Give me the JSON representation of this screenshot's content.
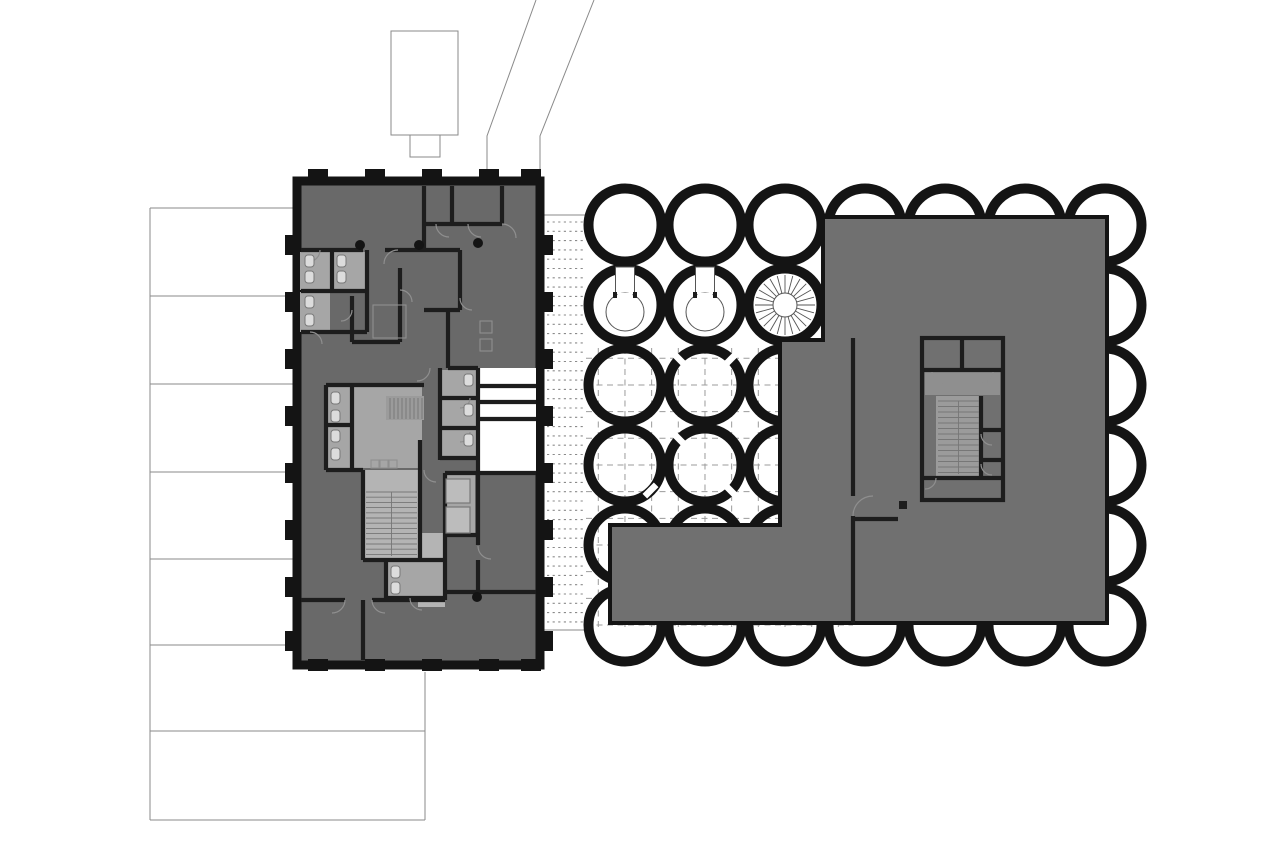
{
  "meta": {
    "title": "architectural-site-plan",
    "description": "Black and white site plan: existing rectangular building at left, courtyard grid of circular pavilions, large new building volume at right with scalloped circle edges",
    "canvas": {
      "width": 1280,
      "height": 854
    }
  },
  "palette": {
    "paper": "#ffffff",
    "ink": "#141414",
    "wall": "#1d1d1d",
    "bldgLeft": "#696969",
    "bldgRight": "#707070",
    "roomLight": "#a6a6a6",
    "stairLight": "#b4b4b4",
    "lobby": "#8f8f8f",
    "coreStair": "#9b9b9b",
    "lineGray": "#8a8a8a",
    "dashGray": "#9b9b9b",
    "arcGray": "#8f8f8f",
    "treadGray": "#777777",
    "spokeGray": "#555555",
    "fixtureFill": "#dcdcdc",
    "fixtureStroke": "#787878",
    "elevBox": "#bcbcbc"
  },
  "site": {
    "access_road": {
      "polylines": [
        [
          536,
          0,
          487,
          136,
          487,
          181
        ],
        [
          594,
          0,
          540,
          136,
          540,
          181
        ]
      ]
    },
    "outbuilding": {
      "rects": [
        [
          391,
          31,
          67,
          104
        ],
        [
          410,
          135,
          30,
          22
        ]
      ]
    },
    "parcel_rows": {
      "h_lines": [
        [
          150,
          208,
          297
        ],
        [
          150,
          296,
          297
        ],
        [
          150,
          384,
          297
        ],
        [
          150,
          472,
          297
        ],
        [
          150,
          559,
          297
        ],
        [
          150,
          645,
          297
        ],
        [
          150,
          731,
          425
        ],
        [
          150,
          820,
          425
        ]
      ],
      "v_lines": [
        [
          150,
          208,
          820
        ],
        [
          425,
          672,
          820
        ]
      ]
    },
    "walkway": {
      "x1": 547,
      "x2": 586,
      "y_start": 222,
      "step": 9.3,
      "count": 44,
      "top_line": [
        544,
        215,
        594,
        215
      ],
      "bottom_line": [
        544,
        630,
        612,
        630
      ]
    }
  },
  "courtyard": {
    "circle_grid": {
      "cols": 7,
      "rows": 6,
      "cx0": 625,
      "cy0": 225,
      "pitch": 80,
      "r": 36.5,
      "ring_width": 10
    },
    "paving_grid": {
      "clip": [
        586,
        348,
        267,
        279
      ],
      "x_start": 598.3,
      "y_start": 358.3,
      "pitch": 26.67,
      "x_count": 10,
      "y_count": 11
    },
    "keyhole_pavilions": [
      {
        "cx": 625,
        "cy": 305
      },
      {
        "cx": 705,
        "cy": 305
      }
    ],
    "keyhole_shape": {
      "neck_w": 19,
      "neck_top": 267,
      "neck_bottom": 297,
      "bowl_r": 19,
      "bowl_dy": 7
    },
    "spiral_stair": {
      "cx": 785,
      "cy": 305,
      "r_inner": 12,
      "r_outer": 30,
      "step_deg": 15
    },
    "ring_openings": [
      {
        "x": 679.5,
        "y": 359.5,
        "rot": 45
      },
      {
        "x": 730.5,
        "y": 359.5,
        "rot": -45
      },
      {
        "x": 679.5,
        "y": 439.5,
        "rot": 45
      },
      {
        "x": 730.5,
        "y": 490.5,
        "rot": 45
      },
      {
        "x": 650.5,
        "y": 490.5,
        "rot": -45
      }
    ],
    "opening_size": {
      "w": 16,
      "h": 6.5
    }
  },
  "left_building": {
    "footprint": {
      "x": 297,
      "y": 181,
      "w": 243,
      "h": 484
    },
    "pilasters": {
      "left_wall_y": [
        245,
        302,
        359,
        416,
        473,
        530,
        587,
        641
      ],
      "right_wall_y": [
        245,
        302,
        359,
        416,
        473,
        530,
        587,
        641
      ],
      "top_wall_x": [
        318,
        375,
        432,
        489,
        531
      ],
      "bottom_wall_x": [
        318,
        375,
        432,
        489,
        531
      ]
    },
    "stairs": [
      {
        "name": "main-stair",
        "dir": "h",
        "a1": 366,
        "a2": 417,
        "b0": 492,
        "step": 5.2,
        "n": 13,
        "rail": [
          391.5,
          492,
          391.5,
          556
        ]
      },
      {
        "name": "small-stair",
        "dir": "v",
        "a1": 398,
        "a2": 419,
        "b0": 390,
        "step": 4,
        "n": 9,
        "rail": null
      }
    ]
  },
  "right_building": {
    "outline_points": "823,217 1107,217 1107,623 610,623 610,525 780,525 780,340 823,340",
    "core": {
      "x": 922,
      "y": 338,
      "w": 81,
      "h": 162
    },
    "stairs": [
      {
        "name": "core-stair",
        "dir": "h",
        "a1": 938,
        "a2": 979,
        "b0": 401,
        "step": 5.5,
        "n": 14,
        "rail": [
          958.5,
          401,
          958.5,
          474
        ]
      }
    ]
  }
}
